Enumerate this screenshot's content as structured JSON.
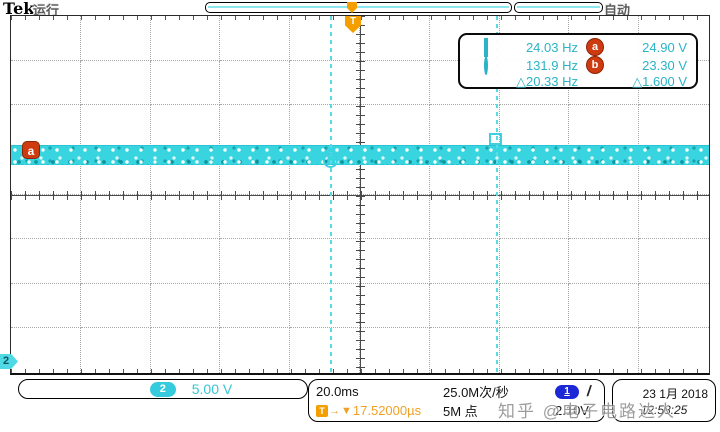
{
  "header": {
    "brand": "Tek",
    "run_status": "运行",
    "acquire_mode": "自动",
    "trigger_marker": "T"
  },
  "cursor_panel": {
    "rows": [
      {
        "symbol": "square-icon",
        "freq": "24.03 Hz",
        "badge": "a",
        "volt": "24.90 V"
      },
      {
        "symbol": "circle-icon",
        "freq": "131.9 Hz",
        "badge": "b",
        "volt": "23.30 V"
      },
      {
        "symbol": "",
        "freq": "△20.33 Hz",
        "badge": "",
        "volt": "△1.600 V"
      }
    ]
  },
  "display": {
    "waveform_level_badge": "a",
    "ground_marker_channel": "2",
    "trigger_flag": "T"
  },
  "statusbar": {
    "ch2": {
      "badge": "2",
      "scale": "5.00 V"
    },
    "horizontal": {
      "timebase": "20.0ms",
      "sample_rate": "25.0M次/秒",
      "trigger_icon": "T",
      "arrow_right": "→",
      "arrow_down": "▼",
      "delay": "17.52000µs",
      "record_length": "5M 点"
    },
    "trigger": {
      "source_badge": "1",
      "slope": "/",
      "level": "2.10V"
    },
    "datetime": {
      "date": "23 1月 2018",
      "time": "12:58:25"
    }
  },
  "watermark": {
    "text": "知乎 @电子电路达人"
  },
  "colors": {
    "channel2_cyan": "#38d5e1",
    "cursor_cyan_text": "#2ab4c6",
    "badge_red_orange": "#cf3b10",
    "trigger_orange": "#f59e00",
    "delay_text_orange": "#f0a026",
    "trigger_source_blue": "#1c27d6",
    "grid_dot_gray": "#a6a6a6"
  }
}
